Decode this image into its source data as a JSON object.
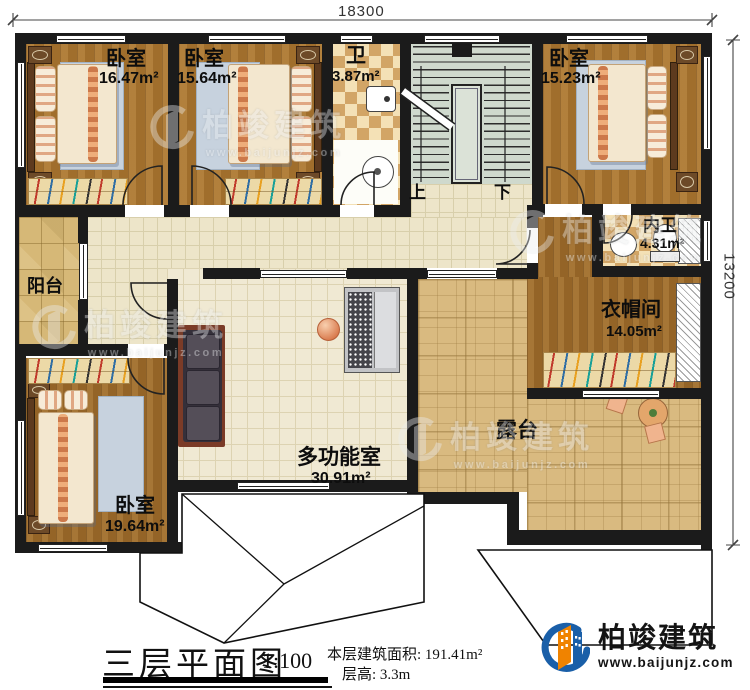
{
  "dimensions": {
    "width_mm": "18300",
    "height_mm": "13200"
  },
  "rooms": {
    "bedroom_tl": {
      "label": "卧室",
      "area": "16.47m²"
    },
    "bedroom_tm": {
      "label": "卧室",
      "area": "15.64m²"
    },
    "bath": {
      "label": "卫",
      "area": "3.87m²"
    },
    "bedroom_tr": {
      "label": "卧室",
      "area": "15.23m²"
    },
    "ensuite": {
      "label": "内卫",
      "area": "4.31m²"
    },
    "cloakroom": {
      "label": "衣帽间",
      "area": "14.05m²"
    },
    "balcony": {
      "label": "阳台"
    },
    "bedroom_bl": {
      "label": "卧室",
      "area": "19.64m²"
    },
    "multi": {
      "label": "多功能室",
      "area": "30.91m²"
    },
    "terrace": {
      "label": "露台"
    }
  },
  "stairs": {
    "up": "上",
    "down": "下"
  },
  "titleblock": {
    "title": "三层平面图",
    "scale": "1:100",
    "area_label": "本层建筑面积:",
    "area_value": "191.41m²",
    "floor_height_label": "层高:",
    "floor_height_value": "3.3m"
  },
  "brand": {
    "name": "柏竣建筑",
    "website": "www.baijunjz.com"
  },
  "watermark": {
    "name": "柏竣建筑",
    "website": "www.baijunjz.com"
  },
  "colors": {
    "wall": "#1b1b1b",
    "accent_blue": "#1a5fa8",
    "accent_orange": "#f08300"
  }
}
